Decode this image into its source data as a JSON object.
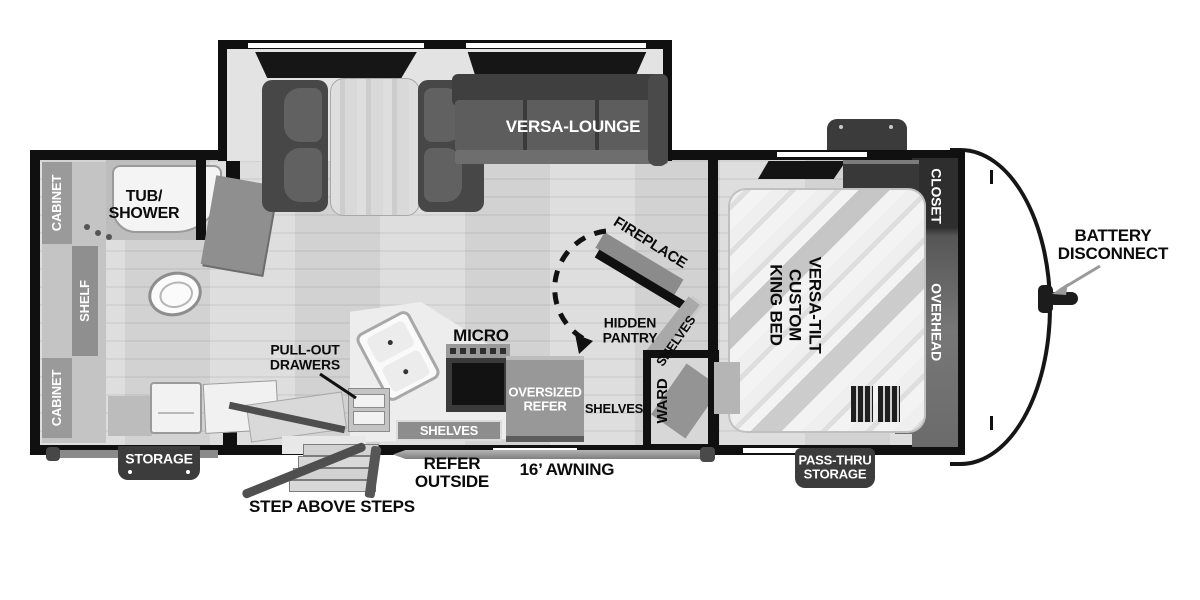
{
  "title": "Travel trailer floor plan",
  "colors": {
    "wall": "#101010",
    "floor": "#d8d8d8",
    "slide_floor": "#e3e3e3",
    "furniture_dark": "#474747",
    "furniture_mid": "#8d8d8d",
    "badge": "#3c3c3c",
    "white": "#ffffff"
  },
  "living_area": {
    "versa_lounge": "VERSA-LOUNGE",
    "fireplace": "FIREPLACE",
    "hidden_pantry": "HIDDEN\nPANTRY",
    "pantry_shelves": "SHELVES"
  },
  "kitchen": {
    "micro": "MICRO",
    "pull_out_drawers": "PULL-OUT\nDRAWERS",
    "shelves_badge": "SHELVES",
    "oversized_refer": "OVERSIZED\nREFER",
    "shelves_small": "SHELVES",
    "ward": "WARD"
  },
  "bathroom": {
    "tub_shower": "TUB/\nSHOWER",
    "cabinet_top": "CABINET",
    "shelf": "SHELF",
    "cabinet_bottom": "CABINET"
  },
  "bedroom": {
    "bed": "VERSA-TILT\nCUSTOM\nKING BED",
    "closet": "CLOSET",
    "overhead": "OVERHEAD"
  },
  "exterior": {
    "battery_disconnect": "BATTERY\nDISCONNECT",
    "storage": "STORAGE",
    "pass_thru_storage": "PASS-THRU\nSTORAGE",
    "awning": "16’ AWNING",
    "refer_outside": "REFER\nOUTSIDE",
    "step_above_steps": "STEP ABOVE STEPS"
  }
}
